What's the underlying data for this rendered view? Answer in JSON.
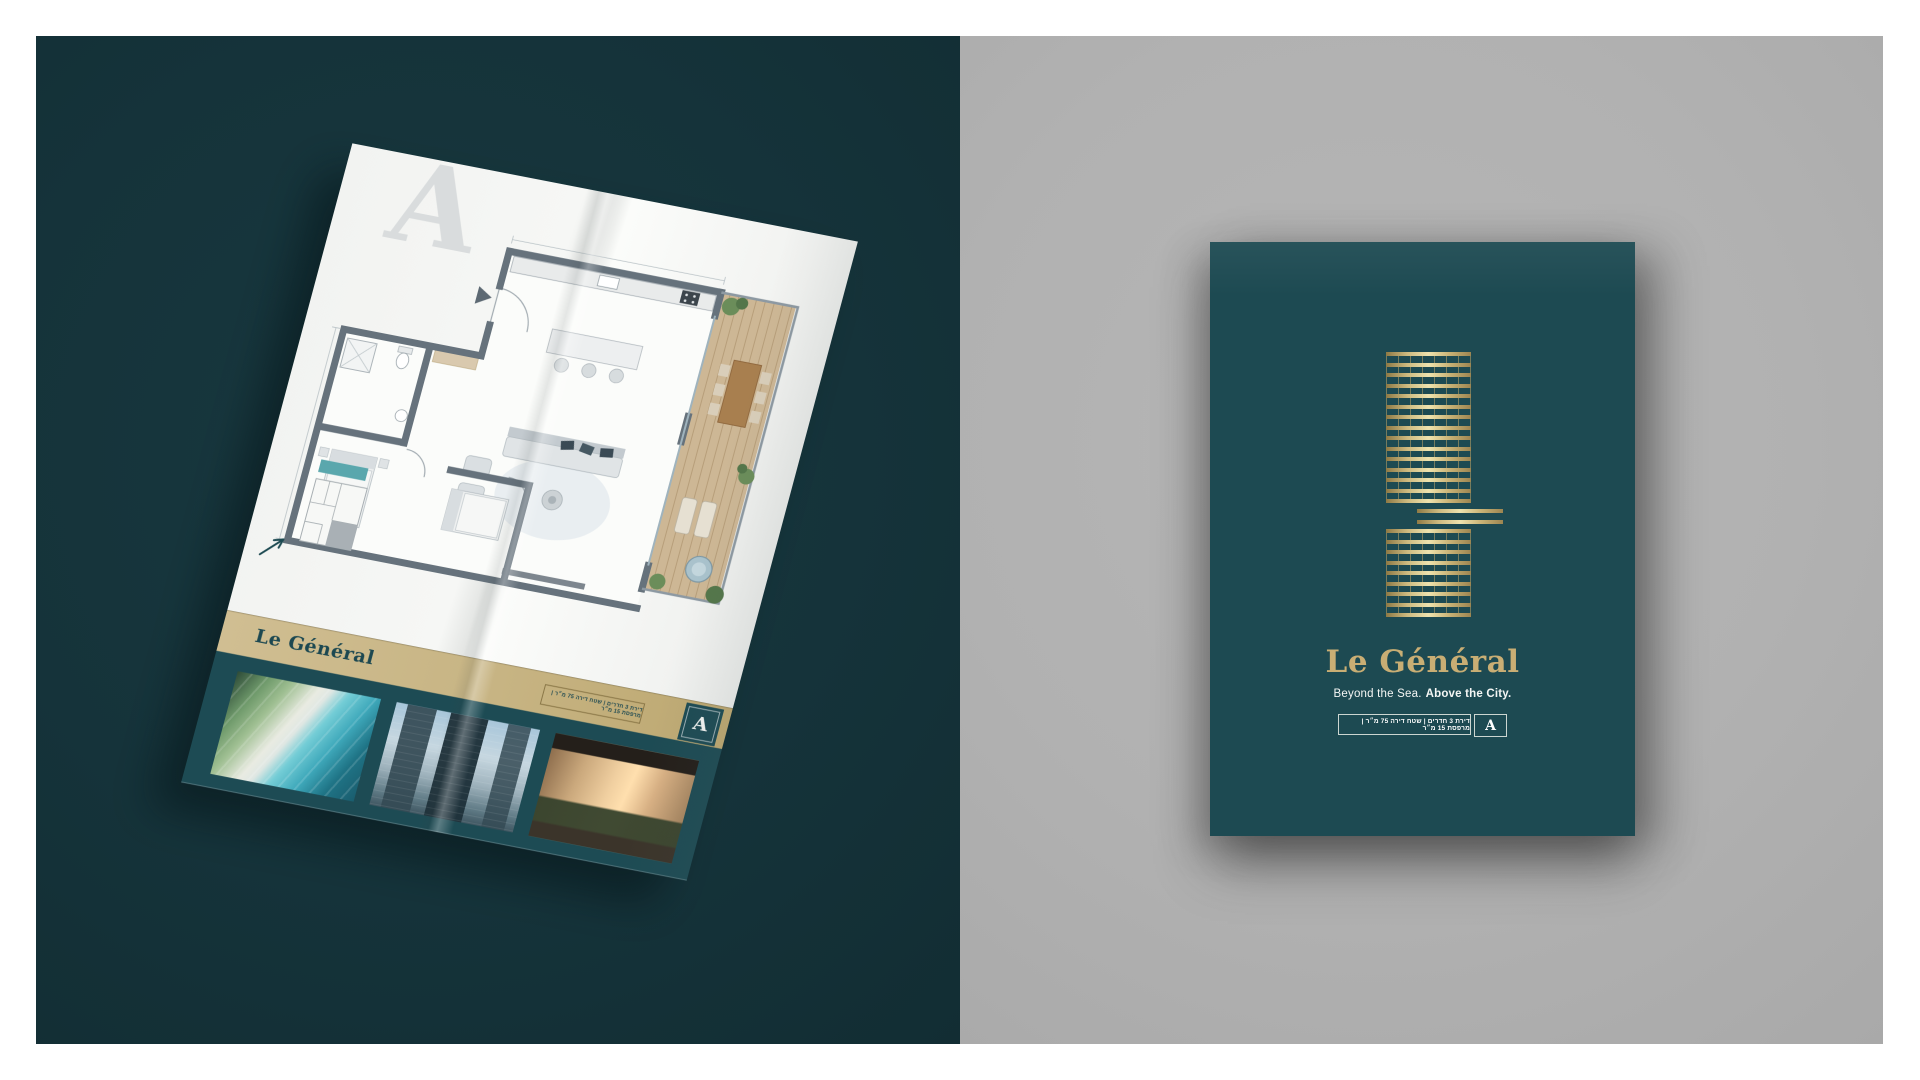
{
  "page": {
    "background": "#FFFFFF"
  },
  "left_panel": {
    "background": "#16343A",
    "brochure": {
      "watermark_letter": "A",
      "band": {
        "title": "Le Général",
        "specs": "דירת 3 חדרים | שטח דירה 75 מ״ר | מרפסת 15 מ״ר",
        "unit_letter": "A",
        "band_color": "#C7B483"
      },
      "photos": [
        {
          "name": "pool-aerial-photo"
        },
        {
          "name": "tower-exterior-photo"
        },
        {
          "name": "living-room-interior-photo"
        }
      ]
    }
  },
  "right_panel": {
    "background": "#B2B2B2",
    "cover": {
      "background": "#1D4A52",
      "logo": {
        "name": "building-facade-icon",
        "color": "#C9AE74",
        "top_floors": 15,
        "mid_floors": 2,
        "bottom_floors": 9
      },
      "title": "Le Général",
      "title_color": "#C9AE74",
      "tagline_regular": "Beyond the Sea.",
      "tagline_bold": "Above the City.",
      "specs": "דירת 3 חדרים | שטח דירה 75 מ״ר | מרפסת 15 מ״ר",
      "unit_letter": "A"
    }
  }
}
